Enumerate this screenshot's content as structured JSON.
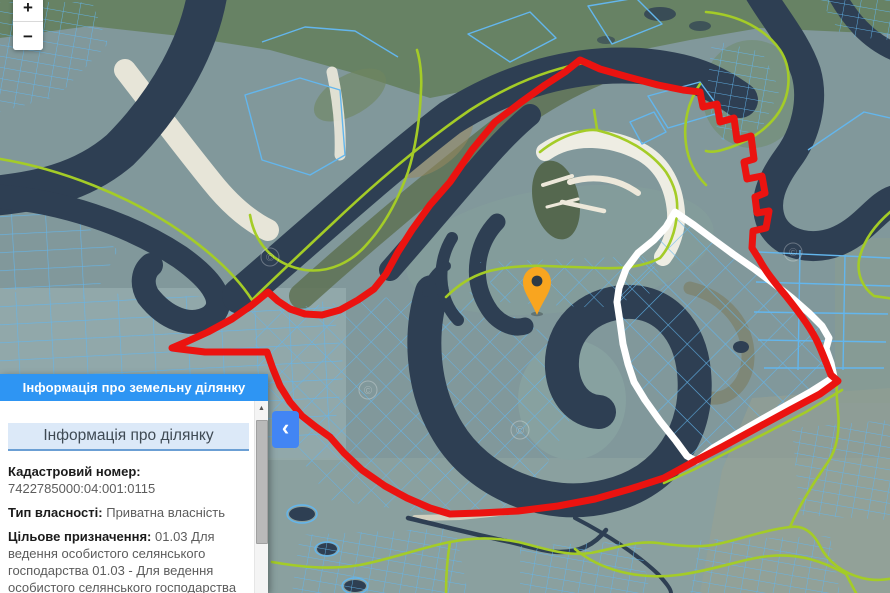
{
  "map": {
    "controls": {
      "zoom_in_label": "+",
      "zoom_out_label": "−"
    },
    "watermark_symbol": "©",
    "marker": {
      "present": true
    },
    "colors": {
      "selected_parcel_boundary": "#EB1310",
      "highlighted_parcel_boundary": "#FFFFFF",
      "cadastral_parcel_lines": "#63B6ED",
      "settlement_boundary": "#A4CC27",
      "water": "#2E3F53",
      "marker": "#F9A51F",
      "panel_header": "#2E95F3",
      "collapse_button": "#4285F4"
    }
  },
  "panel": {
    "title": "Інформація про земельну ділянку",
    "section_title": "Інформація про ділянку",
    "collapse_icon": "‹",
    "scroll_up_icon": "▲",
    "fields": [
      {
        "label": "Кадастровий номер:",
        "value": "7422785000:04:001:0115"
      },
      {
        "label": "Тип власності:",
        "value": "Приватна власність"
      },
      {
        "label": "Цільове призначення:",
        "value": "01.03 Для ведення особистого селянського господарства 01.03 - Для ведення особистого селянського господарства"
      },
      {
        "label": "Площа:",
        "value": "1.6864 га"
      }
    ]
  }
}
